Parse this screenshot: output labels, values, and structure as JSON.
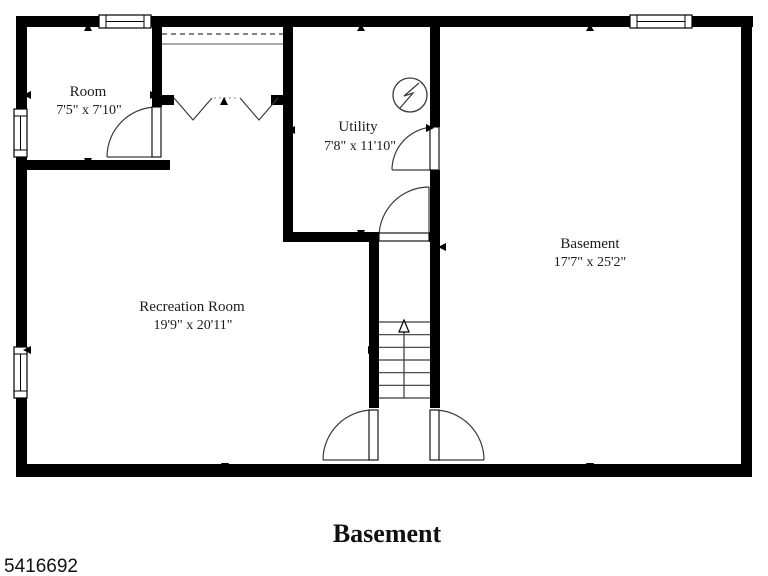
{
  "plan_title": "Basement",
  "id_number": "5416692",
  "rooms": {
    "room": {
      "name": "Room",
      "dims": "7'5\" x 7'10\""
    },
    "utility": {
      "name": "Utility",
      "dims": "7'8\" x 11'10\""
    },
    "basement": {
      "name": "Basement",
      "dims": "17'7\" x 25'2\""
    },
    "recreation": {
      "name": "Recreation Room",
      "dims": "19'9\" x 20'11\""
    }
  },
  "symbols": {
    "electrical_panel": "circle-with-lightning-bolt",
    "stairs_direction": "up"
  },
  "colors": {
    "walls": "#000000",
    "background": "#ffffff",
    "thin_lines": "#3a3a3a",
    "text": "#1c1c1c"
  }
}
